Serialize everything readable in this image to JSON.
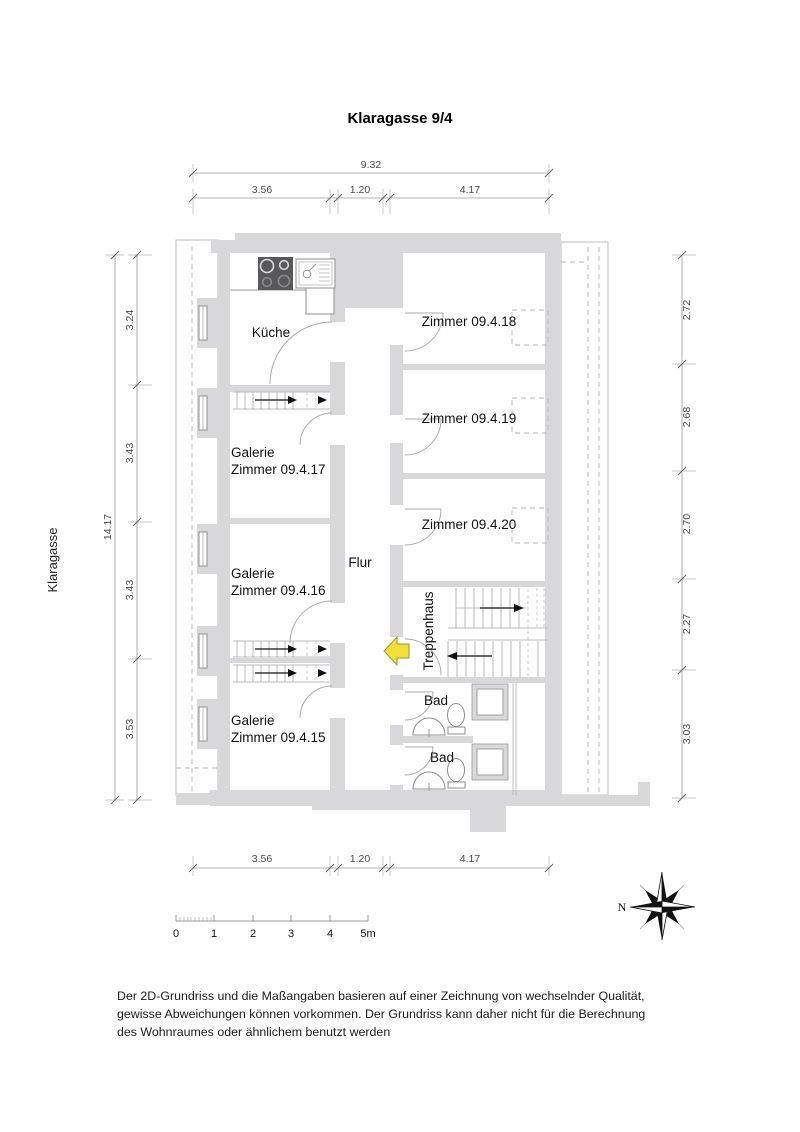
{
  "title": "Klaragasse 9/4",
  "street": "Klaragasse",
  "compass_label": "N",
  "rooms": {
    "kueche": "Küche",
    "z18": "Zimmer 09.4.18",
    "z19": "Zimmer 09.4.19",
    "z20": "Zimmer 09.4.20",
    "flur": "Flur",
    "treppenhaus": "Treppenhaus",
    "bad1": "Bad",
    "bad2": "Bad",
    "g17": [
      "Galerie",
      "Zimmer 09.4.17"
    ],
    "g16": [
      "Galerie",
      "Zimmer 09.4.16"
    ],
    "g15": [
      "Galerie",
      "Zimmer 09.4.15"
    ]
  },
  "dimensions": {
    "top_overall": "9.32",
    "top_segments": [
      "3.56",
      "1.20",
      "4.17"
    ],
    "bottom_segments": [
      "3.56",
      "1.20",
      "4.17"
    ],
    "left_overall": "14.17",
    "left_segments": [
      "3.24",
      "3.43",
      "3.43",
      "3.53"
    ],
    "right_segments": [
      "2.72",
      "2.68",
      "2.70",
      "2.27",
      "3.03"
    ]
  },
  "scale_bar": [
    "0",
    "1",
    "2",
    "3",
    "4",
    "5m"
  ],
  "disclaimer": [
    "Der 2D-Grundriss und die Maßangaben basieren auf einer Zeichnung von wechselnder Qualität,",
    "gewisse Abweichungen können vorkommen. Der Grundriss kann daher nicht für die Berechnung",
    "des Wohnraumes oder ähnlichem benutzt werden"
  ],
  "icons": {
    "compass-rose-icon": "compass rose pointing N to the left",
    "entry-arrow-icon": "yellow entrance arrow pointing left",
    "stove-icon": "4-burner cooktop",
    "kitchen-sink-icon": "sink with faucet and drainer",
    "toilet-icon": "WC",
    "washbasin-icon": "round washbasin",
    "shower-icon": "square shower tray",
    "window-icon": "double-line window",
    "stair-icon": "stair run with direction arrow"
  },
  "colors": {
    "wall_fill": "#d8d8da",
    "stove_fill": "#58585a",
    "entry_arrow": "#f3df39",
    "line": "#9a9a9a",
    "text": "#111111",
    "dim_text": "#4a4a4a"
  }
}
